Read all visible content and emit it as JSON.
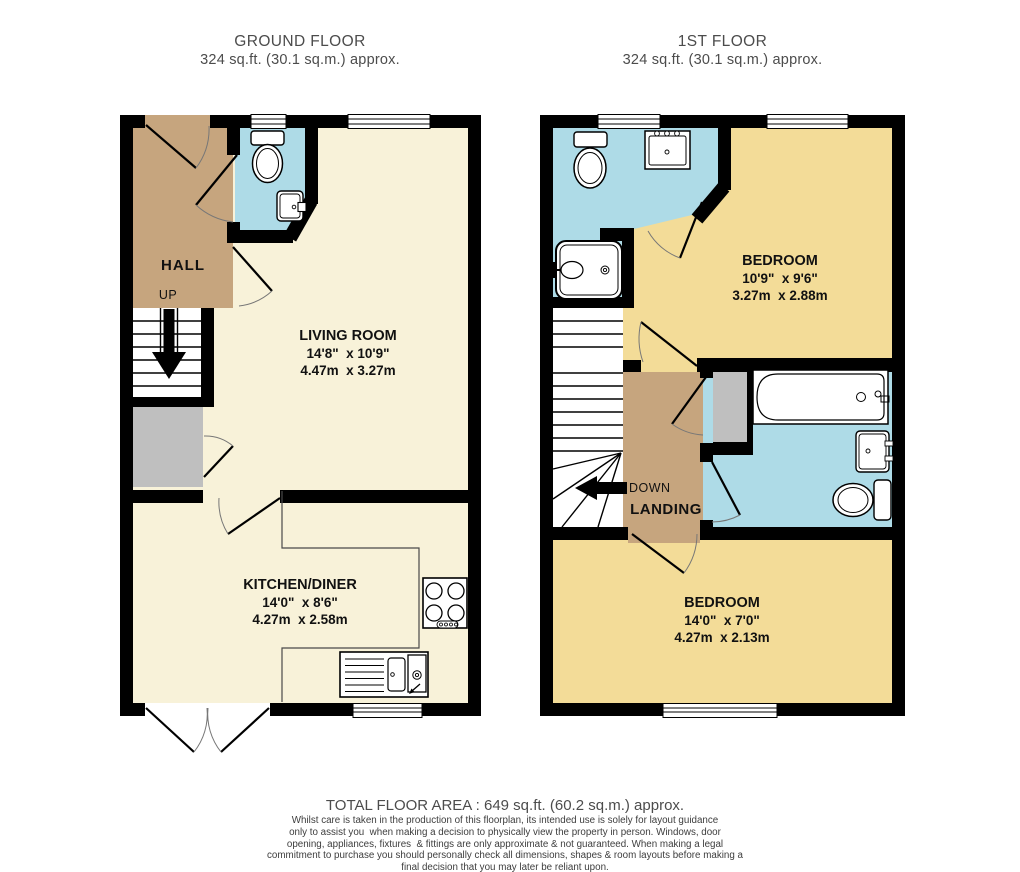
{
  "ground_floor": {
    "title": "GROUND FLOOR",
    "area": "324 sq.ft. (30.1 sq.m.) approx.",
    "rooms": {
      "hall": {
        "name": "HALL",
        "direction": "UP"
      },
      "living": {
        "name": "LIVING ROOM",
        "imperial": "14'8\"  x 10'9\"",
        "metric": "4.47m  x 3.27m"
      },
      "kitchen": {
        "name": "KITCHEN/DINER",
        "imperial": "14'0\"  x 8'6\"",
        "metric": "4.27m  x 2.58m"
      }
    }
  },
  "first_floor": {
    "title": "1ST FLOOR",
    "area": "324 sq.ft. (30.1 sq.m.) approx.",
    "rooms": {
      "bedroom1": {
        "name": "BEDROOM",
        "imperial": "10'9\"  x 9'6\"",
        "metric": "3.27m  x 2.88m"
      },
      "bedroom2": {
        "name": "BEDROOM",
        "imperial": "14'0\"  x 7'0\"",
        "metric": "4.27m  x 2.13m"
      },
      "landing": {
        "name": "LANDING",
        "direction": "DOWN"
      }
    }
  },
  "footer": {
    "total_area": "TOTAL FLOOR AREA : 649 sq.ft. (60.2 sq.m.) approx.",
    "disclaimer_lines": [
      "Whilst care is taken in the production of this floorplan, its intended use is solely for layout guidance",
      "only to assist you  when making a decision to physically view the property in person. Windows, door",
      "opening, appliances, fixtures  & fittings are only approximate & not guaranteed. When making a legal",
      "commitment to purchase you should personally check all dimensions, shapes & room layouts before making a",
      "final decision that you may later be reliant upon."
    ]
  },
  "colors": {
    "wall": "#000000",
    "living_kitchen": "#f8f2d9",
    "hall_landing": "#c6a57e",
    "bathroom_blue": "#aedbe7",
    "bedroom_yellow": "#f3dc98",
    "cupboard_gray": "#bfbfbf"
  }
}
